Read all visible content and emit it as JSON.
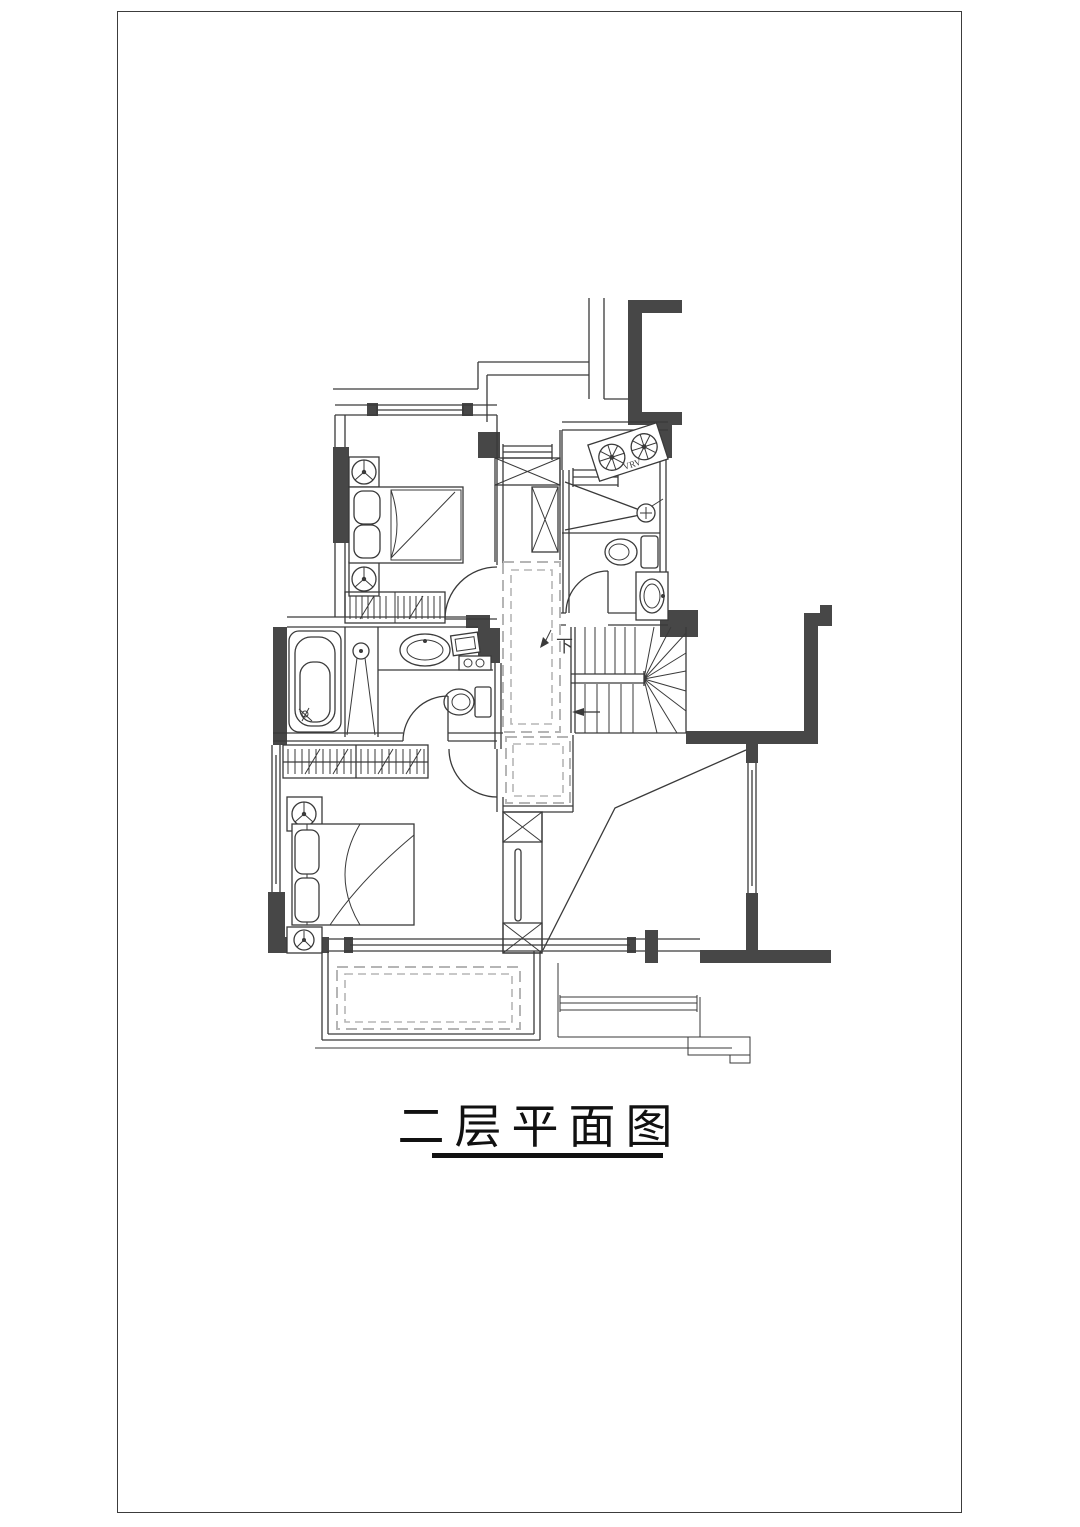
{
  "page": {
    "title": "二层平面图",
    "background": "#ffffff",
    "border_color": "#3c3c3c"
  },
  "plan": {
    "labels": {
      "stairs_down": "下",
      "ac_unit": "VRV"
    },
    "colors": {
      "wall_fill": "#474747",
      "line": "#3a3a3a",
      "dashed_line": "#b5b5b5",
      "title_color": "#111111"
    }
  }
}
